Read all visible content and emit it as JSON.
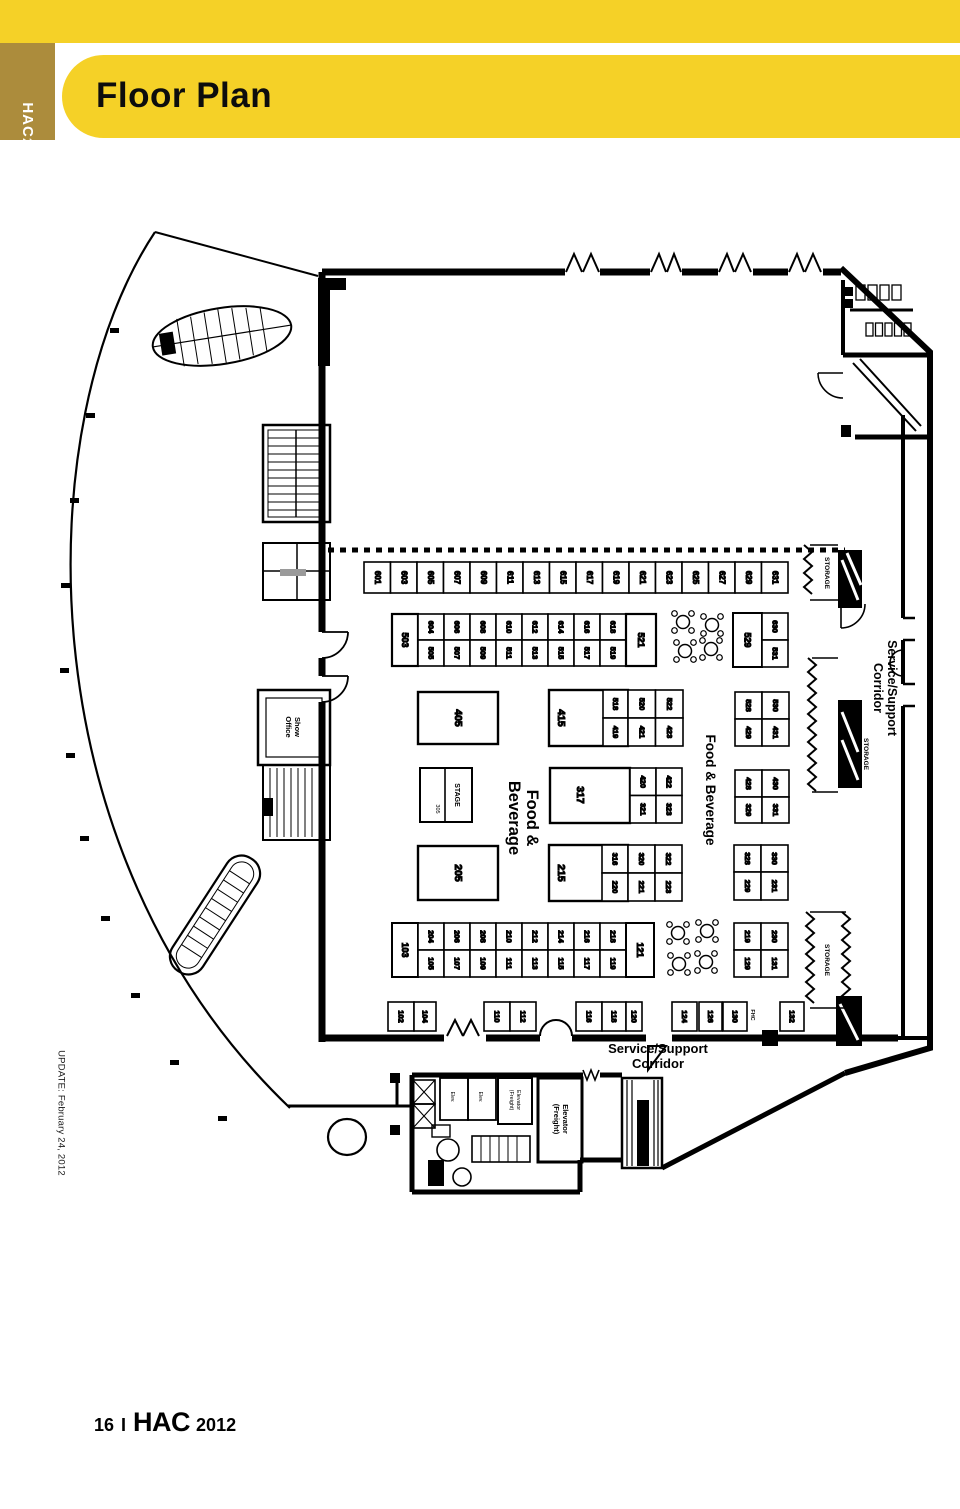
{
  "header": {
    "tab_brand": "HAC",
    "tab_year": "2012",
    "title": "Floor Plan"
  },
  "footer": {
    "page_number": "16",
    "separator": "I",
    "brand": "HAC",
    "year": "2012"
  },
  "colors": {
    "yellow": "#F5D127",
    "gold": "#AC8C3C",
    "ink": "#000000"
  },
  "plan": {
    "update_note": "UPDATE: February 24, 2012",
    "labels": {
      "corridor_right": [
        "Service/Support",
        "Corridor"
      ],
      "corridor_bottom": [
        "Service/Support",
        "Corridor"
      ],
      "food_beverage_main": [
        "Food &",
        "Beverage"
      ],
      "food_beverage_right": "Food & Beverage",
      "storage": "STORAGE",
      "stage": "STAGE",
      "stage_number": "305",
      "show_office": [
        "Show",
        "Office"
      ],
      "elevator_freight": [
        "Elevator",
        "(Freight)"
      ],
      "elevator_small": "Elev.",
      "fhc": "FHC"
    },
    "booths": {
      "row_600": [
        "601",
        "603",
        "605",
        "607",
        "609",
        "611",
        "613",
        "615",
        "617",
        "619",
        "621",
        "623",
        "625",
        "627",
        "629",
        "631"
      ],
      "island_56_left": "503",
      "island_56_top": [
        "604",
        "606",
        "608",
        "610",
        "612",
        "614",
        "616",
        "618"
      ],
      "island_56_bottom": [
        "505",
        "507",
        "509",
        "511",
        "513",
        "515",
        "517",
        "519"
      ],
      "island_56_right": "521",
      "block_529": [
        "529",
        "630",
        "531"
      ],
      "b405": "405",
      "b415": "415",
      "cells_415": [
        "518",
        "419"
      ],
      "pairs_45": [
        [
          "520",
          "421"
        ],
        [
          "522",
          "423"
        ]
      ],
      "grp_45_right": [
        [
          "528",
          "429"
        ],
        [
          "530",
          "431"
        ]
      ],
      "b317": "317",
      "pairs_34": [
        [
          "420",
          "321"
        ],
        [
          "422",
          "323"
        ]
      ],
      "grp_34_right": [
        [
          "428",
          "329"
        ],
        [
          "430",
          "331"
        ]
      ],
      "b205": "205",
      "b215": "215",
      "cells_215": [
        "316",
        "220"
      ],
      "pairs_23": [
        [
          "320",
          "221"
        ],
        [
          "322",
          "223"
        ]
      ],
      "grp_23_right": [
        [
          "328",
          "229"
        ],
        [
          "330",
          "231"
        ]
      ],
      "b103": "103",
      "island_12_top": [
        "204",
        "206",
        "208",
        "210",
        "212",
        "214",
        "216",
        "218"
      ],
      "island_12_bottom": [
        "105",
        "107",
        "109",
        "111",
        "113",
        "115",
        "117",
        "119"
      ],
      "b121": "121",
      "grp_12_right": [
        [
          "219",
          "129"
        ],
        [
          "230",
          "131"
        ]
      ],
      "row_100_a": [
        "102",
        "104"
      ],
      "row_100_b": [
        "110",
        "112"
      ],
      "row_100_c": [
        "116",
        "118",
        "120"
      ],
      "row_100_d": [
        "124",
        "126",
        "130"
      ],
      "row_100_e": [
        "132"
      ]
    }
  }
}
